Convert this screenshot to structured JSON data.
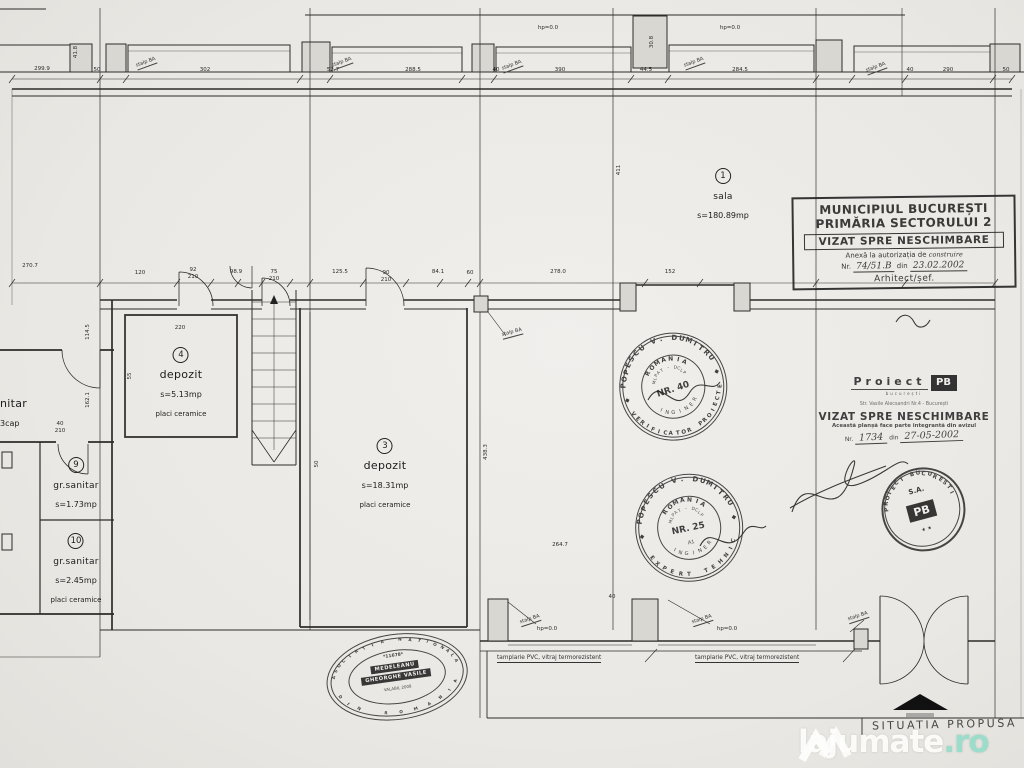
{
  "rooms": {
    "sala": {
      "num": "1",
      "name": "sala",
      "area": "s=180.89mp"
    },
    "dep3": {
      "num": "3",
      "name": "depozit",
      "area": "s=18.31mp",
      "note": "placi ceramice"
    },
    "dep4": {
      "num": "4",
      "name": "depozit",
      "area": "s=5.13mp",
      "note": "placi ceramice"
    },
    "gs9": {
      "num": "9",
      "name": "gr.sanitar",
      "area": "s=1.73mp"
    },
    "gs10": {
      "num": "10",
      "name": "gr.sanitar",
      "area": "s=2.45mp",
      "note": "placi ceramice"
    },
    "cut": {
      "name": "nitar",
      "area": "3cap"
    }
  },
  "stamps": {
    "municipal": {
      "line1": "MUNICIPIUL BUCUREȘTI",
      "line2": "PRIMĂRIA SECTORULUI 2",
      "visa": "VIZAT SPRE NESCHIMBARE",
      "annex": "Anexă la autorizația de",
      "annex_hand": "construire",
      "nr_label": "Nr.",
      "nr_hand": "74/51.B",
      "din": "din",
      "date_hand": "23.02.2002",
      "official": "Arhitect/șef."
    },
    "proiect": {
      "brand": "Proiect",
      "logo": "PB",
      "brand_sub": "bucurești",
      "address": "Str. Vasile Alecsandri Nr.4 - București",
      "visa": "VIZAT SPRE NESCHIMBARE",
      "note": "Această planșă face parte integrantă din avizul",
      "nr_label": "Nr.",
      "nr_hand": "1734",
      "din": "din",
      "date_hand": "27-05-2002"
    },
    "round1": {
      "ring": "POPESCU V. DUMITRU",
      "bottom": "VERIFICATOR PROIECTE",
      "country": "ROMANIA",
      "org": "MLPAT - DCLP",
      "nr": "NR. 40",
      "inner_bottom": "INGINER",
      "sep": "◆"
    },
    "round2": {
      "ring": "POPESCU V. DUMITRU",
      "bottom": "EXPERT TEHNIC",
      "country": "ROMANIA",
      "org": "MLPAT - DCLP",
      "nr": "NR. 25",
      "cls": "A1",
      "inner_bottom": "INGINER",
      "sep": "◆"
    },
    "pb": {
      "ring": "PROIECT BUCURESTI",
      "sa": "S.A.",
      "logo": "PB",
      "stars": "★ ★"
    },
    "oval": {
      "ring_top": "ASOCIATIA NATIONALA",
      "ring_bottom": "DIN ROMANIA",
      "num": "*11678*",
      "name1": "MEDELEANU",
      "name2": "GHEORGHE VASILE",
      "valid": "VALABIL 2008"
    }
  },
  "labels": {
    "pvc": "tamplarie PVC, vitraj termorezistent",
    "situatia": "SITUATIA  PROPUSA"
  },
  "watermark": {
    "brand": "lajumate",
    "tld": ".ro",
    "accent": "#9bdccb"
  },
  "dims": [
    {
      "t": "299.9",
      "x": 42,
      "y": 69
    },
    {
      "t": "50",
      "x": 97,
      "y": 70
    },
    {
      "t": "302",
      "x": 205,
      "y": 70
    },
    {
      "t": "52.7",
      "x": 333,
      "y": 70
    },
    {
      "t": "288.5",
      "x": 413,
      "y": 70
    },
    {
      "t": "40",
      "x": 496,
      "y": 70
    },
    {
      "t": "390",
      "x": 560,
      "y": 70
    },
    {
      "t": "44.5",
      "x": 646,
      "y": 70
    },
    {
      "t": "284.5",
      "x": 740,
      "y": 70
    },
    {
      "t": "40",
      "x": 910,
      "y": 70
    },
    {
      "t": "290",
      "x": 948,
      "y": 70
    },
    {
      "t": "50",
      "x": 1006,
      "y": 70
    },
    {
      "t": "41.8",
      "x": 76,
      "y": 52,
      "r": -90
    },
    {
      "t": "30.8",
      "x": 652,
      "y": 42,
      "r": -90
    },
    {
      "t": "hp=0.0",
      "x": 548,
      "y": 28
    },
    {
      "t": "hp=0.0",
      "x": 730,
      "y": 28
    },
    {
      "t": "stalp BA",
      "x": 146,
      "y": 63,
      "r": -20,
      "c": "stalp"
    },
    {
      "t": "stalp BA",
      "x": 342,
      "y": 63,
      "r": -20,
      "c": "stalp"
    },
    {
      "t": "stalp BA",
      "x": 512,
      "y": 66,
      "r": -20,
      "c": "stalp"
    },
    {
      "t": "stalp BA",
      "x": 694,
      "y": 63,
      "r": -20,
      "c": "stalp"
    },
    {
      "t": "stalp BA",
      "x": 876,
      "y": 68,
      "r": -20,
      "c": "stalp"
    },
    {
      "t": "270.7",
      "x": 30,
      "y": 266
    },
    {
      "t": "120",
      "x": 140,
      "y": 273
    },
    {
      "t": "92",
      "x": 193,
      "y": 270
    },
    {
      "t": "210",
      "x": 193,
      "y": 277
    },
    {
      "t": "98.9",
      "x": 236,
      "y": 272
    },
    {
      "t": "75",
      "x": 274,
      "y": 272
    },
    {
      "t": "210",
      "x": 274,
      "y": 279
    },
    {
      "t": "125.5",
      "x": 340,
      "y": 272
    },
    {
      "t": "90",
      "x": 386,
      "y": 273
    },
    {
      "t": "210",
      "x": 386,
      "y": 280
    },
    {
      "t": "84.1",
      "x": 438,
      "y": 272
    },
    {
      "t": "60",
      "x": 470,
      "y": 273
    },
    {
      "t": "278.0",
      "x": 558,
      "y": 272
    },
    {
      "t": "152",
      "x": 670,
      "y": 272
    },
    {
      "t": "220",
      "x": 180,
      "y": 328
    },
    {
      "t": "55",
      "x": 130,
      "y": 376,
      "r": -90
    },
    {
      "t": "114.5",
      "x": 88,
      "y": 332,
      "r": -90
    },
    {
      "t": "162.1",
      "x": 88,
      "y": 400,
      "r": -90
    },
    {
      "t": "40",
      "x": 60,
      "y": 424
    },
    {
      "t": "210",
      "x": 60,
      "y": 431
    },
    {
      "t": "411",
      "x": 619,
      "y": 170,
      "r": -90
    },
    {
      "t": "438.3",
      "x": 486,
      "y": 452,
      "r": -90
    },
    {
      "t": "50",
      "x": 317,
      "y": 464,
      "r": -90
    },
    {
      "t": "264.7",
      "x": 560,
      "y": 545
    },
    {
      "t": "40",
      "x": 612,
      "y": 597
    },
    {
      "t": "hp=0.0",
      "x": 547,
      "y": 629
    },
    {
      "t": "hp=0.0",
      "x": 727,
      "y": 629
    },
    {
      "t": "stalp BA",
      "x": 530,
      "y": 620,
      "r": -18,
      "c": "stalp"
    },
    {
      "t": "stalp BA",
      "x": 702,
      "y": 620,
      "r": -18,
      "c": "stalp"
    },
    {
      "t": "stalp BA",
      "x": 858,
      "y": 617,
      "r": -18,
      "c": "stalp"
    },
    {
      "t": "stalp BA",
      "x": 512,
      "y": 333,
      "r": -15,
      "c": "stalp"
    }
  ]
}
